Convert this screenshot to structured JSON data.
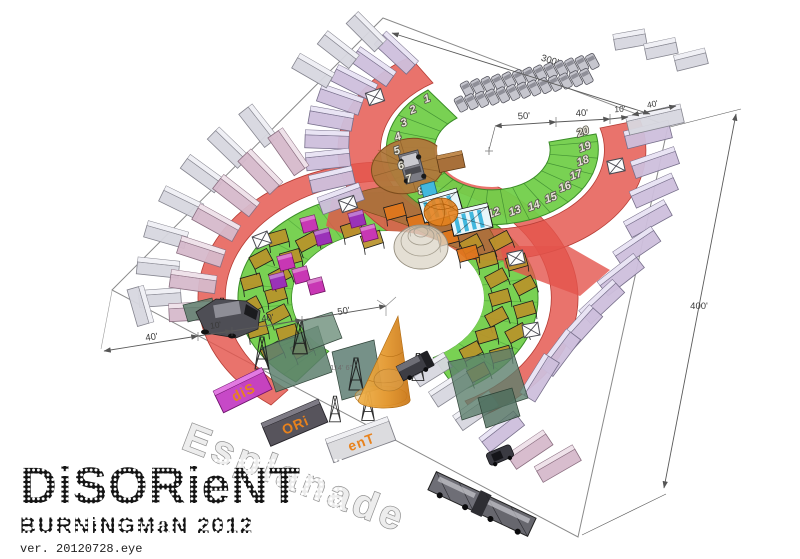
{
  "plan": {
    "esplanade_label": "Esplanade",
    "dims": {
      "top": "300'",
      "right": "400'",
      "u50": "50'",
      "u40": "40'",
      "u10": "10'",
      "ucontainer": "40'",
      "l40a": "40'",
      "l10": "10'",
      "l40b": "40'",
      "l50": "50'",
      "spire_height": "114' 6\""
    },
    "wedges": [
      "1",
      "2",
      "3",
      "4",
      "5",
      "6",
      "7",
      "8",
      "9",
      "10",
      "11",
      "12",
      "13",
      "14",
      "15",
      "16",
      "17",
      "18",
      "19",
      "20"
    ],
    "letter_containers": [
      "diS",
      "ORi",
      "enT"
    ]
  },
  "footer": {
    "logo": "DiSORieNT",
    "subtitle": "BURNiNGMaN 2012",
    "version": "ver. 20120728.eye"
  },
  "colors": {
    "green": "#72cf4a",
    "green_line": "#3b8d28",
    "red": "#e4544c",
    "brown": "#a9713b",
    "amber": "#b8922a",
    "orange": "#e0761c",
    "magenta": "#c837b4",
    "purple": "#9a32b8",
    "lavender": "#cdbfdc",
    "pink": "#d6b9cb",
    "gray_container": "#d7d7df",
    "blue": "#42b8de"
  }
}
